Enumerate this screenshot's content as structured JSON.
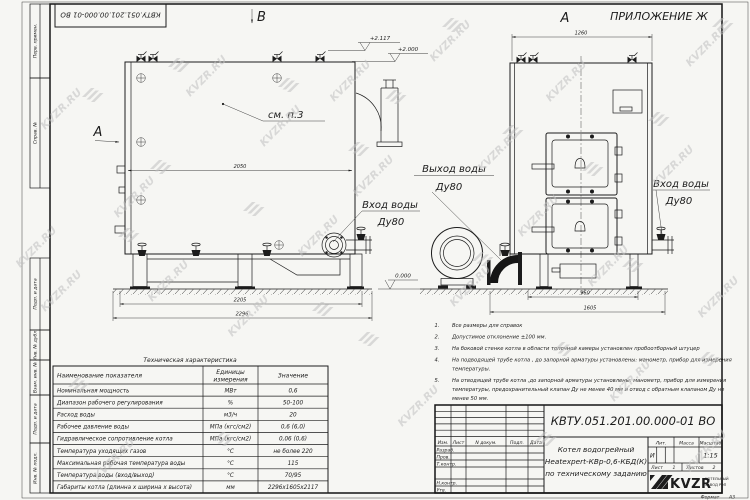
{
  "page": {
    "watermark": "KVZR.RU",
    "bg": "#f6f6f3",
    "ink": "#1c1c1c",
    "watermark_color": "#bfbfbf"
  },
  "frame": {
    "stamp_number_top": "КВТУ.051.201.00.000-01 ВО",
    "left_labels": [
      "Перв. примен.",
      "Справ. №",
      "Подп. и дата",
      "Инв. № дубл.",
      "Взам. инв. №",
      "Подп. и дата",
      "Инв. № подл."
    ],
    "format_label": "Формат",
    "format_value": "А3"
  },
  "drawing": {
    "appendix": "ПРИЛОЖЕНИЕ Ж",
    "view_b": "В",
    "view_a_side": "А",
    "view_a_front": "А",
    "see_note": "см. п.3",
    "elev_top1": "+2.117",
    "elev_top2": "+2.000",
    "elev_zero": "0.000",
    "outlet_line1": "Выход воды",
    "outlet_line2": "Ду80",
    "inlet_side_line1": "Вход воды",
    "inlet_side_line2": "Ду80",
    "inlet_front_line1": "Вход воды",
    "inlet_front_line2": "Ду80",
    "dim_side_width": "2050",
    "dim_side_base": "2205",
    "dim_side_total": "2296",
    "dim_front_width": "1260",
    "dim_front_base": "960",
    "dim_front_total": "1605"
  },
  "notes": {
    "items": [
      {
        "num": "1.",
        "lines": [
          "Все размеры для справок"
        ]
      },
      {
        "num": "2.",
        "lines": [
          "Допустимое отклонение  ±100 мм."
        ]
      },
      {
        "num": "3.",
        "lines": [
          "На боковой стенке котла в области топочной камеры установлен пробоотборный штуцер"
        ]
      },
      {
        "num": "4.",
        "lines": [
          "На  подводящей трубе котла , до запорной арматуры установлены: манометр, прибор для измерения",
          "температуры."
        ]
      },
      {
        "num": "5.",
        "lines": [
          "На отводящей трубе котла ,до запорной арматуры установлены: манометр, прибор для измерения",
          "температуры, предохранительный клапан Ду не менее 40 мм и отвод с обратным клапаном Ду не",
          "менее 50 мм."
        ]
      }
    ]
  },
  "spec": {
    "title": "Техническая характеристика",
    "col_name": "Наименование показателя",
    "col_unit_1": "Единицы",
    "col_unit_2": "измерения",
    "col_value": "Значение",
    "rows": [
      {
        "name": "Номинальная мощность",
        "unit": "МВт",
        "value": "0,6"
      },
      {
        "name": "Диапазон рабочего регулирования",
        "unit": "%",
        "value": "50-100"
      },
      {
        "name": "Расход воды",
        "unit": "м3/ч",
        "value": "20"
      },
      {
        "name": "Рабочее давление воды",
        "unit": "МПа (кгс/см2)",
        "value": "0,6 (6,0)"
      },
      {
        "name": "Гидравлическое сопротивление котла",
        "unit": "МПа (кгс/см2)",
        "value": "0,06 (0,6)"
      },
      {
        "name": "Температура уходящих газов",
        "unit": "°С",
        "value": "не более 220"
      },
      {
        "name": "Максимальная рабочая температура воды",
        "unit": "°С",
        "value": "115"
      },
      {
        "name": "Температура воды (вход/выход)",
        "unit": "°С",
        "value": "70/95"
      },
      {
        "name": "Габариты котла (длинна х ширина х высота)",
        "unit": "мм",
        "value": "2296х1605х2117"
      }
    ]
  },
  "titleblock": {
    "doc_number": "КВТУ.051.201.00.000-01 ВО",
    "name_line1": "Котел водогрейный",
    "name_line2": "Heatexpert-КВр-0,6-КБД(К)",
    "name_line3": "по техническому заданию",
    "hdr_izm": "Изм.",
    "hdr_list": "Лист",
    "hdr_doc": "N докум.",
    "hdr_podp": "Подп.",
    "hdr_data": "Дата",
    "row_razrab": "Разраб.",
    "row_prov": "Пров.",
    "row_tkontr": "Т.контр.",
    "row_nkontr": "Н.контр.",
    "row_utv": "Утв.",
    "lit_label": "Лит.",
    "lit_value": "И",
    "mass_label": "Масса",
    "scale_label": "Масштаб",
    "scale_value": "1:15",
    "sheet_label": "Лист",
    "sheet_value": "1",
    "sheets_label": "Листов",
    "sheets_value": "2",
    "logo": "KVZR",
    "company_line1": "КОТЕЛЬНЫЙ",
    "company_line2": "ЗАВОД РЭП"
  }
}
